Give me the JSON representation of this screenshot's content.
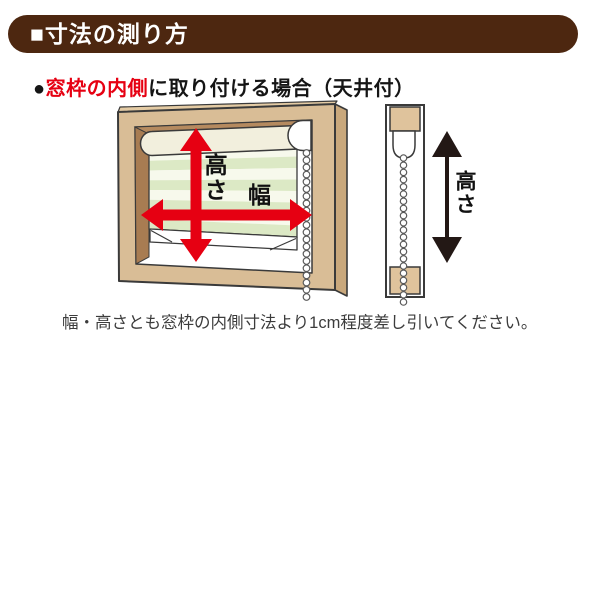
{
  "header": {
    "title": "■寸法の測り方"
  },
  "subtitle": {
    "bullet": "●",
    "highlight": "窓枠の内側",
    "rest": "に取り付ける場合（天井付）"
  },
  "front_view": {
    "height_label": "高さ",
    "width_label": "幅"
  },
  "side_view": {
    "height_label": "高さ"
  },
  "note": "幅・高さとも窓枠の内側寸法より1cm程度差し引いてください。",
  "colors": {
    "accent_red": "#e60012",
    "header_brown": "#4d2710",
    "frame_tan": "#d9bd96",
    "frame_tan_side": "#c9a87c",
    "frame_tan_top": "#e4cba4",
    "head_brown": "#b58a5f",
    "jamb_brown": "#a87c52",
    "tube_cream": "#f2efdd",
    "block_tan": "#dfc39c",
    "stripe_green": "#dce9c5",
    "stripe_cream": "#f7f9ec",
    "arrow_black": "#231815"
  }
}
